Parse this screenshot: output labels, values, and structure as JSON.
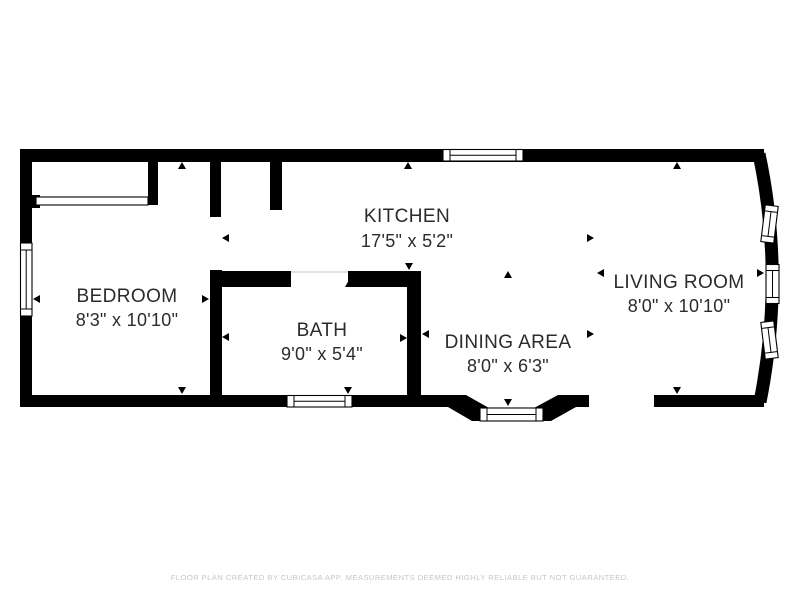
{
  "plan": {
    "type": "floor-plan",
    "rooms": [
      {
        "id": "bedroom",
        "name": "BEDROOM",
        "dimensions": "8'3\" x 10'10\""
      },
      {
        "id": "kitchen",
        "name": "KITCHEN",
        "dimensions": "17'5\" x 5'2\""
      },
      {
        "id": "bath",
        "name": "BATH",
        "dimensions": "9'0\" x 5'4\""
      },
      {
        "id": "dining",
        "name": "DINING AREA",
        "dimensions": "8'0\" x 6'3\""
      },
      {
        "id": "living",
        "name": "LIVING ROOM",
        "dimensions": "8'0\" x 10'10\""
      }
    ],
    "window_count": 7,
    "colors": {
      "wall": "#000000",
      "room_text": "#2b2b2b",
      "footer_text": "#c6c6c6",
      "background": "#ffffff",
      "window_fill": "#ffffff"
    }
  },
  "footer": {
    "disclaimer": "FLOOR PLAN CREATED BY CUBICASA APP. MEASUREMENTS DEEMED HIGHLY RELIABLE BUT NOT GUARANTEED."
  }
}
